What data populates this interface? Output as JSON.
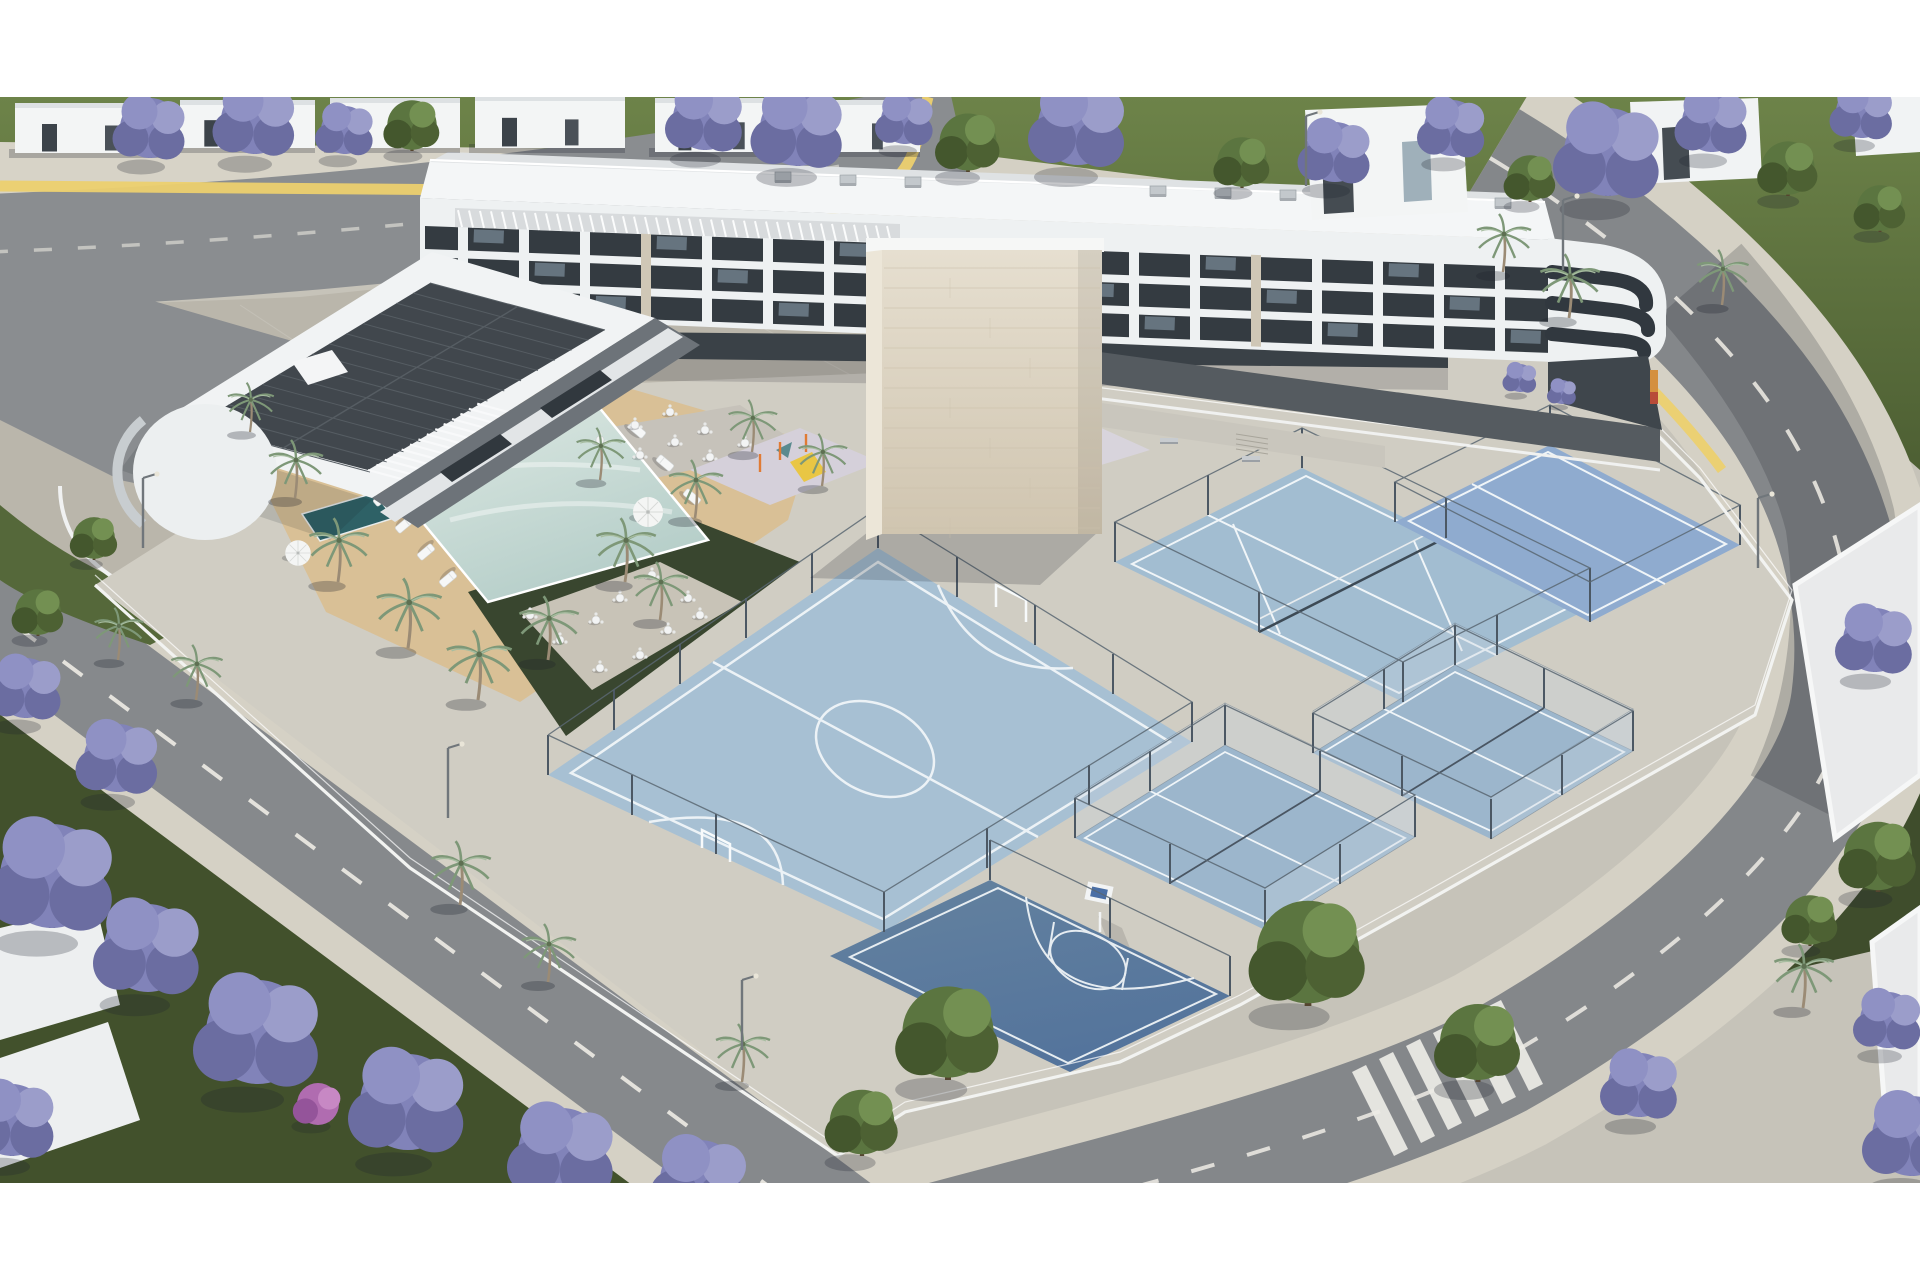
{
  "meta": {
    "title": "Aerial render — residential complex with pool and sports courts",
    "type": "architectural-visualization",
    "no_visible_text": true
  },
  "palette": {
    "page_bg": "#ffffff",
    "ground": "#c6c3b9",
    "plaza": "#bab6ab",
    "sidewalk": "#d7d3c7",
    "block_paving": "#d0cdc3",
    "asphalt": "#85888b",
    "asphalt_dark": "#6a6d71",
    "road_mark": "#edece6",
    "yellow_stripe": "#ecd06f",
    "lawn": "#5f7440",
    "lawn_dark": "#42512c",
    "deck": "#d9c096",
    "pool_water_light": "#dfeae4",
    "pool_water": "#b4cdc8",
    "plunge_pool": "#2e6166",
    "court_futsal": "#a7c0d3",
    "court_tennis": "#a2bdd1",
    "court_tennis2": "#8fabcf",
    "court_padel": "#9cb6cc",
    "court_basket": "#5c7ca4",
    "court_line": "#f0f5f8",
    "fence_white": "#f2f3f1",
    "fence_post": "#4c5864",
    "glass_wall": "rgba(198,212,224,0.34)",
    "building_white": "#eef1f2",
    "slab_white": "#fafbfb",
    "recess_dark": "#343b41",
    "glass_light": "#8fa4b2",
    "stone_light": "#e6dfd0",
    "stone": "#d5cbb7",
    "roof_deck": "#dfe2e4",
    "solar_roof": "#41474d",
    "tree_purple": "#8183b9",
    "tree_green": "#5b7540",
    "magenta_bush": "#b06cb0",
    "palm_frond": "#87a183",
    "palm_trunk": "#9b8b75",
    "pad_lavender": "#d5d0da",
    "equip_orange": "#e07b35",
    "slide_yellow": "#e9c644",
    "shadow": "rgba(28,32,42,0.28)"
  },
  "scene": {
    "areas": {
      "building": "apartment-building-with-stone-tower",
      "pool": "swimming-pool-terrace",
      "futsal": "futsal-court",
      "basketball": "basketball-half-court",
      "tennis": "tennis-courts",
      "padel": "padel-courts-with-glass",
      "playground": "children-playground",
      "calisthenics": "calisthenics-area",
      "crosswalk": "zebra-crossing"
    },
    "jacarandas": [
      [
        150,
        128,
        1.5
      ],
      [
        255,
        120,
        1.7
      ],
      [
        345,
        130,
        1.2
      ],
      [
        705,
        118,
        1.6
      ],
      [
        798,
        128,
        1.9
      ],
      [
        905,
        120,
        1.2
      ],
      [
        1078,
        125,
        2.0
      ],
      [
        1335,
        152,
        1.5
      ],
      [
        1452,
        128,
        1.4
      ],
      [
        1608,
        152,
        2.2
      ],
      [
        1712,
        122,
        1.5
      ],
      [
        1862,
        112,
        1.3
      ],
      [
        1875,
        640,
        1.6
      ],
      [
        1640,
        1085,
        1.6
      ],
      [
        1912,
        1136,
        2.0
      ],
      [
        1888,
        1020,
        1.4
      ],
      [
        52,
        876,
        2.6
      ],
      [
        148,
        948,
        2.2
      ],
      [
        258,
        1032,
        2.6
      ],
      [
        408,
        1102,
        2.4
      ],
      [
        562,
        1152,
        2.2
      ],
      [
        700,
        1180,
        2.0
      ],
      [
        118,
        758,
        1.7
      ],
      [
        26,
        688,
        1.5
      ],
      [
        12,
        1120,
        1.8
      ],
      [
        1520,
        378,
        0.7
      ],
      [
        1562,
        392,
        0.6
      ]
    ],
    "green_trees": [
      [
        412,
        125,
        1.3
      ],
      [
        968,
        142,
        1.5
      ],
      [
        1242,
        162,
        1.3
      ],
      [
        1530,
        178,
        1.2
      ],
      [
        1788,
        168,
        1.4
      ],
      [
        1880,
        208,
        1.2
      ],
      [
        948,
        1032,
        2.4
      ],
      [
        1308,
        952,
        2.7
      ],
      [
        1478,
        1042,
        2.0
      ],
      [
        862,
        1122,
        1.7
      ],
      [
        1878,
        856,
        1.8
      ],
      [
        1810,
        920,
        1.3
      ],
      [
        94,
        538,
        1.1
      ],
      [
        38,
        612,
        1.2
      ]
    ],
    "magenta_bushes": [
      [
        318,
        1104,
        1.4
      ]
    ],
    "palms": [
      [
        295,
        498,
        1.0
      ],
      [
        338,
        582,
        1.1
      ],
      [
        408,
        648,
        1.2
      ],
      [
        478,
        700,
        1.2
      ],
      [
        548,
        660,
        1.1
      ],
      [
        625,
        582,
        1.1
      ],
      [
        695,
        518,
        1.0
      ],
      [
        752,
        452,
        0.9
      ],
      [
        822,
        486,
        0.9
      ],
      [
        250,
        432,
        0.85
      ],
      [
        600,
        480,
        0.9
      ],
      [
        660,
        620,
        1.0
      ],
      [
        460,
        905,
        1.1
      ],
      [
        548,
        982,
        1.0
      ],
      [
        1503,
        272,
        1.0
      ],
      [
        1569,
        318,
        1.1
      ],
      [
        1722,
        305,
        0.95
      ],
      [
        1803,
        1008,
        1.1
      ],
      [
        742,
        1082,
        1.0
      ],
      [
        118,
        660,
        0.9
      ],
      [
        196,
        700,
        0.95
      ]
    ],
    "loungers": [
      [
        384,
        448,
        74
      ],
      [
        410,
        440,
        74
      ],
      [
        437,
        433,
        74
      ],
      [
        463,
        426,
        74
      ],
      [
        490,
        418,
        74
      ],
      [
        516,
        411,
        74
      ],
      [
        543,
        403,
        74
      ],
      [
        569,
        396,
        74
      ],
      [
        382,
        498,
        140
      ],
      [
        404,
        525,
        140
      ],
      [
        426,
        552,
        140
      ],
      [
        448,
        579,
        140
      ],
      [
        637,
        430,
        40
      ],
      [
        665,
        463,
        40
      ],
      [
        692,
        497,
        40
      ]
    ],
    "umbrellas": [
      [
        352,
        470,
        1.1
      ],
      [
        298,
        553,
        0.85
      ],
      [
        648,
        512,
        1.0
      ]
    ],
    "cafe_tables": [
      [
        600,
        440
      ],
      [
        635,
        425
      ],
      [
        670,
        412
      ],
      [
        705,
        430
      ],
      [
        640,
        455
      ],
      [
        675,
        442
      ],
      [
        710,
        457
      ],
      [
        745,
        443
      ],
      [
        530,
        615
      ],
      [
        560,
        640
      ],
      [
        596,
        620
      ],
      [
        620,
        598
      ],
      [
        652,
        575
      ],
      [
        688,
        598
      ],
      [
        640,
        655
      ],
      [
        600,
        668
      ],
      [
        668,
        630
      ],
      [
        700,
        615
      ]
    ],
    "benches": [
      [
        1160,
        438
      ],
      [
        1242,
        456
      ]
    ],
    "fence_posts": [
      [
        548,
        775
      ],
      [
        614,
        730
      ],
      [
        680,
        684
      ],
      [
        746,
        638
      ],
      [
        812,
        593
      ],
      [
        878,
        548
      ],
      [
        957,
        597
      ],
      [
        1035,
        645
      ],
      [
        1113,
        694
      ],
      [
        1192,
        742
      ],
      [
        1089,
        805
      ],
      [
        987,
        868
      ],
      [
        884,
        932
      ],
      [
        716,
        854
      ],
      [
        632,
        815
      ],
      [
        1115,
        562
      ],
      [
        1208,
        515
      ],
      [
        1302,
        468
      ],
      [
        1446,
        538
      ],
      [
        1590,
        608
      ],
      [
        1497,
        655
      ],
      [
        1403,
        702
      ],
      [
        1259,
        632
      ],
      [
        1395,
        522
      ],
      [
        1550,
        445
      ],
      [
        1740,
        545
      ],
      [
        1590,
        622
      ],
      [
        1075,
        838
      ],
      [
        1225,
        745
      ],
      [
        1415,
        837
      ],
      [
        1265,
        930
      ],
      [
        1150,
        791
      ],
      [
        1320,
        791
      ],
      [
        1340,
        884
      ],
      [
        1170,
        884
      ],
      [
        1313,
        753
      ],
      [
        1455,
        665
      ],
      [
        1633,
        751
      ],
      [
        1491,
        839
      ],
      [
        1384,
        709
      ],
      [
        1544,
        708
      ],
      [
        1562,
        795
      ],
      [
        1402,
        796
      ],
      [
        990,
        880
      ],
      [
        1110,
        938
      ],
      [
        1230,
        996
      ]
    ],
    "ac_units": [
      [
        775,
        172
      ],
      [
        840,
        175
      ],
      [
        905,
        177
      ],
      [
        1150,
        186
      ],
      [
        1215,
        188
      ],
      [
        1280,
        190
      ],
      [
        1350,
        193
      ],
      [
        1425,
        196
      ],
      [
        1495,
        198
      ],
      [
        450,
        275,
        0.8
      ],
      [
        500,
        290,
        0.8
      ],
      [
        550,
        303,
        0.8
      ],
      [
        598,
        317,
        0.8
      ]
    ],
    "light_poles": [
      [
        143,
        548
      ],
      [
        448,
        818
      ],
      [
        742,
        1050
      ],
      [
        1306,
        186
      ],
      [
        1563,
        270
      ],
      [
        1758,
        568
      ]
    ],
    "houses_flat": [
      [
        15,
        103,
        150,
        50
      ],
      [
        180,
        100,
        135,
        48
      ],
      [
        330,
        98,
        130,
        50
      ],
      [
        475,
        96,
        150,
        52
      ],
      [
        655,
        98,
        130,
        54
      ],
      [
        800,
        100,
        120,
        52
      ]
    ],
    "crosswalk": {
      "x0": 1352,
      "y0": 1072,
      "n": 6,
      "step_x": 27,
      "step_y": -13,
      "bar_x": 42,
      "bar_y": 84,
      "w_x": 14,
      "w_y": -7
    },
    "facade": {
      "x0": 458,
      "n": 18,
      "dx": 61,
      "slope": 0.037,
      "pier_w": 10,
      "pier_y": 224,
      "pier_h": 92,
      "band_tops": [
        226,
        257,
        288
      ],
      "glass_w": 30,
      "glass_h": 13
    },
    "pergola_roof": {
      "x0": 458,
      "n": 40,
      "dx": 11,
      "y0": 210,
      "slope": 0.037,
      "len": 17
    },
    "pergola_wing": {
      "x0": 368,
      "y0": 470,
      "n": 14,
      "ux": 8.4,
      "uy": -5.1,
      "vx": 52,
      "vy": 14
    },
    "wing_solar": {
      "ax": 195,
      "ay": 425,
      "ux": 235,
      "uy": -142,
      "vx": 175,
      "vy": 47,
      "cols": 14,
      "rows": 2
    },
    "tower_joints": {
      "x0": 884,
      "x1": 1100,
      "y0": 268,
      "y1": 528,
      "step": 20
    },
    "calisthenics_bars": [
      [
        905,
        445
      ],
      [
        925,
        430
      ],
      [
        945,
        452
      ],
      [
        975,
        428
      ],
      [
        1000,
        446
      ],
      [
        1030,
        425
      ],
      [
        1060,
        440
      ],
      [
        920,
        458
      ]
    ]
  }
}
